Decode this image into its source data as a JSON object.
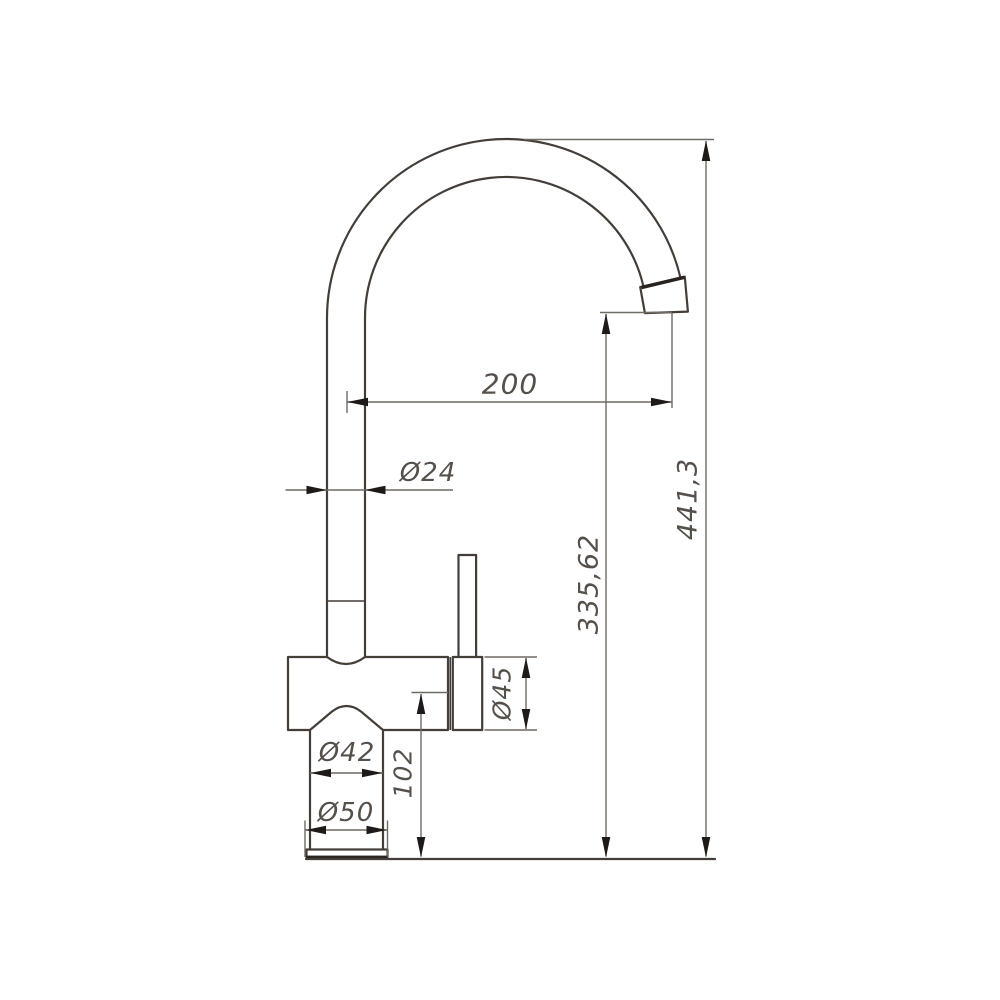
{
  "drawing": {
    "type": "technical-dimension-drawing",
    "subject": "kitchen mixer tap, side elevation with dimensions (mm)",
    "labels": {
      "spout_reach": "200",
      "spout_tube_diameter": "Ø24",
      "overall_height": "441,3",
      "outlet_height": "335,62",
      "handle_housing_diameter": "Ø45",
      "body_height": "102",
      "body_diameter": "Ø42",
      "base_diameter": "Ø50"
    },
    "colors": {
      "object_line": "#443e39",
      "dimension_line": "#6f6a64",
      "arrow": "#1d1a17",
      "text": "#55504a",
      "background": "#ffffff"
    }
  }
}
